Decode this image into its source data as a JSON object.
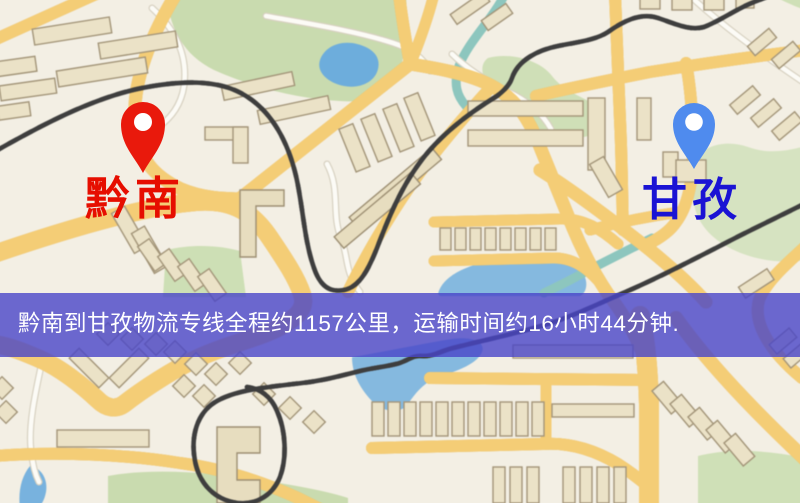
{
  "banner": {
    "text": "黔南到甘孜物流专线全程约1157公里，运输时间约16小时44分钟.",
    "bg_color": "rgba(73,69,200,0.8)",
    "text_color": "#ffffff"
  },
  "route": {
    "origin": "黔南",
    "destination": "甘孜",
    "distance_text": "约1157公里",
    "duration_text": "约16小时44分钟"
  },
  "markers": {
    "origin": {
      "label": "黔南",
      "pin_color": "#e9190c",
      "label_color": "#e60e00"
    },
    "destination": {
      "label": "甘孜",
      "pin_color": "#4f8bee",
      "label_color": "#1a13d4"
    }
  },
  "map_colors": {
    "background": "#f3efe4",
    "road_major": "#f3cd79",
    "road_casing": "#dfae52",
    "park": "#c9dbb0",
    "water": "#74aeda",
    "railway": "#3e3e3e"
  }
}
